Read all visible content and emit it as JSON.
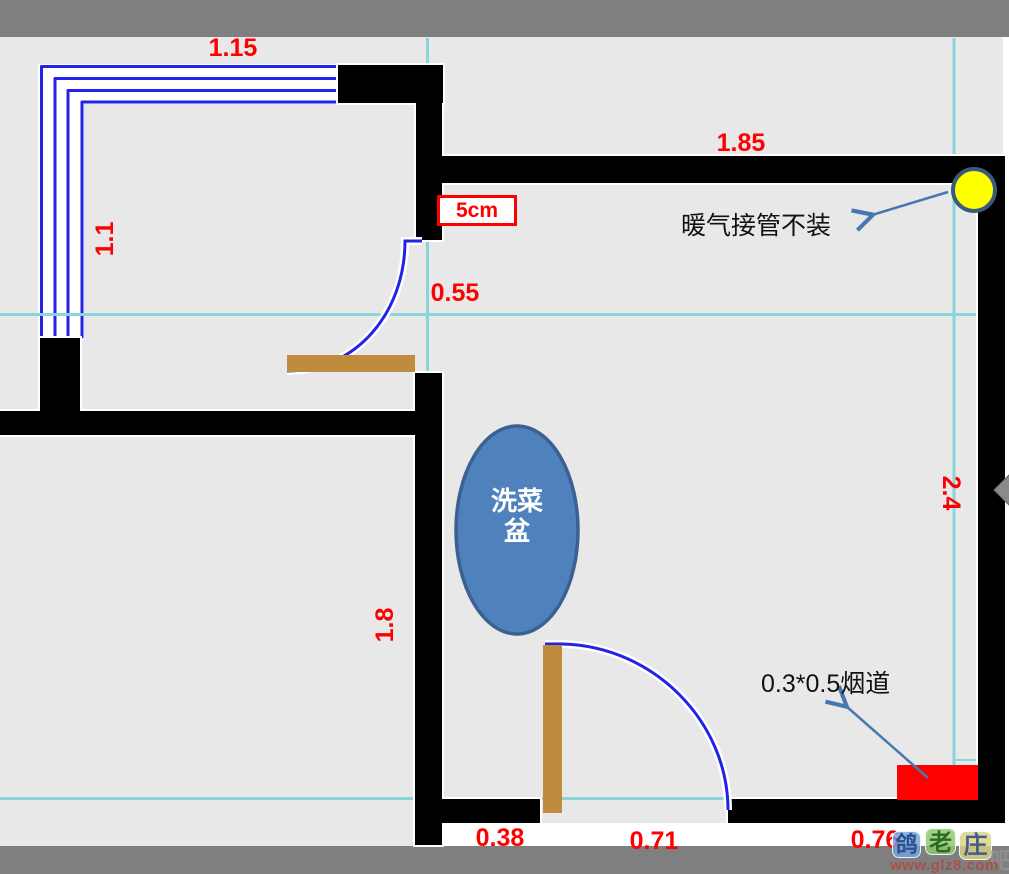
{
  "dimensions": {
    "top_window": "1.15",
    "left_window": "1.1",
    "top_wall": "1.85",
    "upper_door": "0.55",
    "left_wall": "1.8",
    "right_wall": "2.4",
    "bottom_left": "0.38",
    "bottom_door": "0.71",
    "bottom_right": "0.76"
  },
  "annotations": {
    "wall_thickness": "5cm",
    "heating_note": "暖气接管不装",
    "flue_note": "0.3*0.5烟道",
    "sink_line1": "洗菜",
    "sink_line2": "盆"
  },
  "watermark": {
    "badge1": "鸽",
    "badge2": "老",
    "badge3": "庄",
    "badge4": "吧",
    "url": "www.glz8.com"
  },
  "colors": {
    "dimension_red": "#fe0000",
    "wall_black": "#000000",
    "guide_cyan": "#8ad5dc",
    "window_door_blue": "#2222e8",
    "door_leaf_brown": "#bf8b3d",
    "sink_fill_blue": "#4f81bd",
    "sink_border_blue": "#3a6191",
    "flue_red": "#fe0000",
    "circle_yellow": "#ffff00",
    "circle_border": "#3a5a7d",
    "arrow_blue": "#4677b2",
    "frame_gray": "#7f7f7f",
    "background_gray": "#e8e8e8"
  }
}
